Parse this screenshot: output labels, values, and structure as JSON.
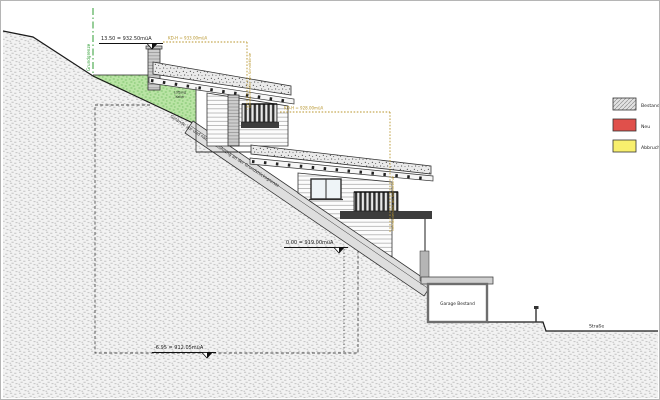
{
  "annotations": {
    "property_line_label": "Grundgrenze",
    "slope_label": "Gelände vor und nach Bauführung an der Grundstücksgrenze",
    "vent_label_line1": "Lüftung",
    "vent_label_line2": "Keller",
    "level_top": "13.50 = 932.50müA",
    "level_zero": "0.00 = 919.00müA",
    "level_bottom": "-6.95 = 912.05müA",
    "height_upper": "KD-H = 933.00müA",
    "height_lower": "KD-H = 928.00müA",
    "height_upper_vertical": "Gebäudehöhe an Schnittlinie",
    "height_lower_vertical": "Gebäudehöhe an Schnittlinie",
    "garage_label": "Garage Bestand",
    "street_label": "Straße"
  },
  "legend": {
    "items": [
      {
        "label": "Bestand",
        "color": "#e2e2e2",
        "style": "hatched"
      },
      {
        "label": "Neu",
        "color": "#e0504b",
        "style": "solid"
      },
      {
        "label": "Abbruch",
        "color": "#f8ef6d",
        "style": "solid"
      }
    ]
  },
  "colors": {
    "terrain_grass": "#b9e4a4",
    "dimension_accent": "#b8962e",
    "property_line_green": "#2f9e33",
    "earth_fill": "#f2f2f2"
  }
}
